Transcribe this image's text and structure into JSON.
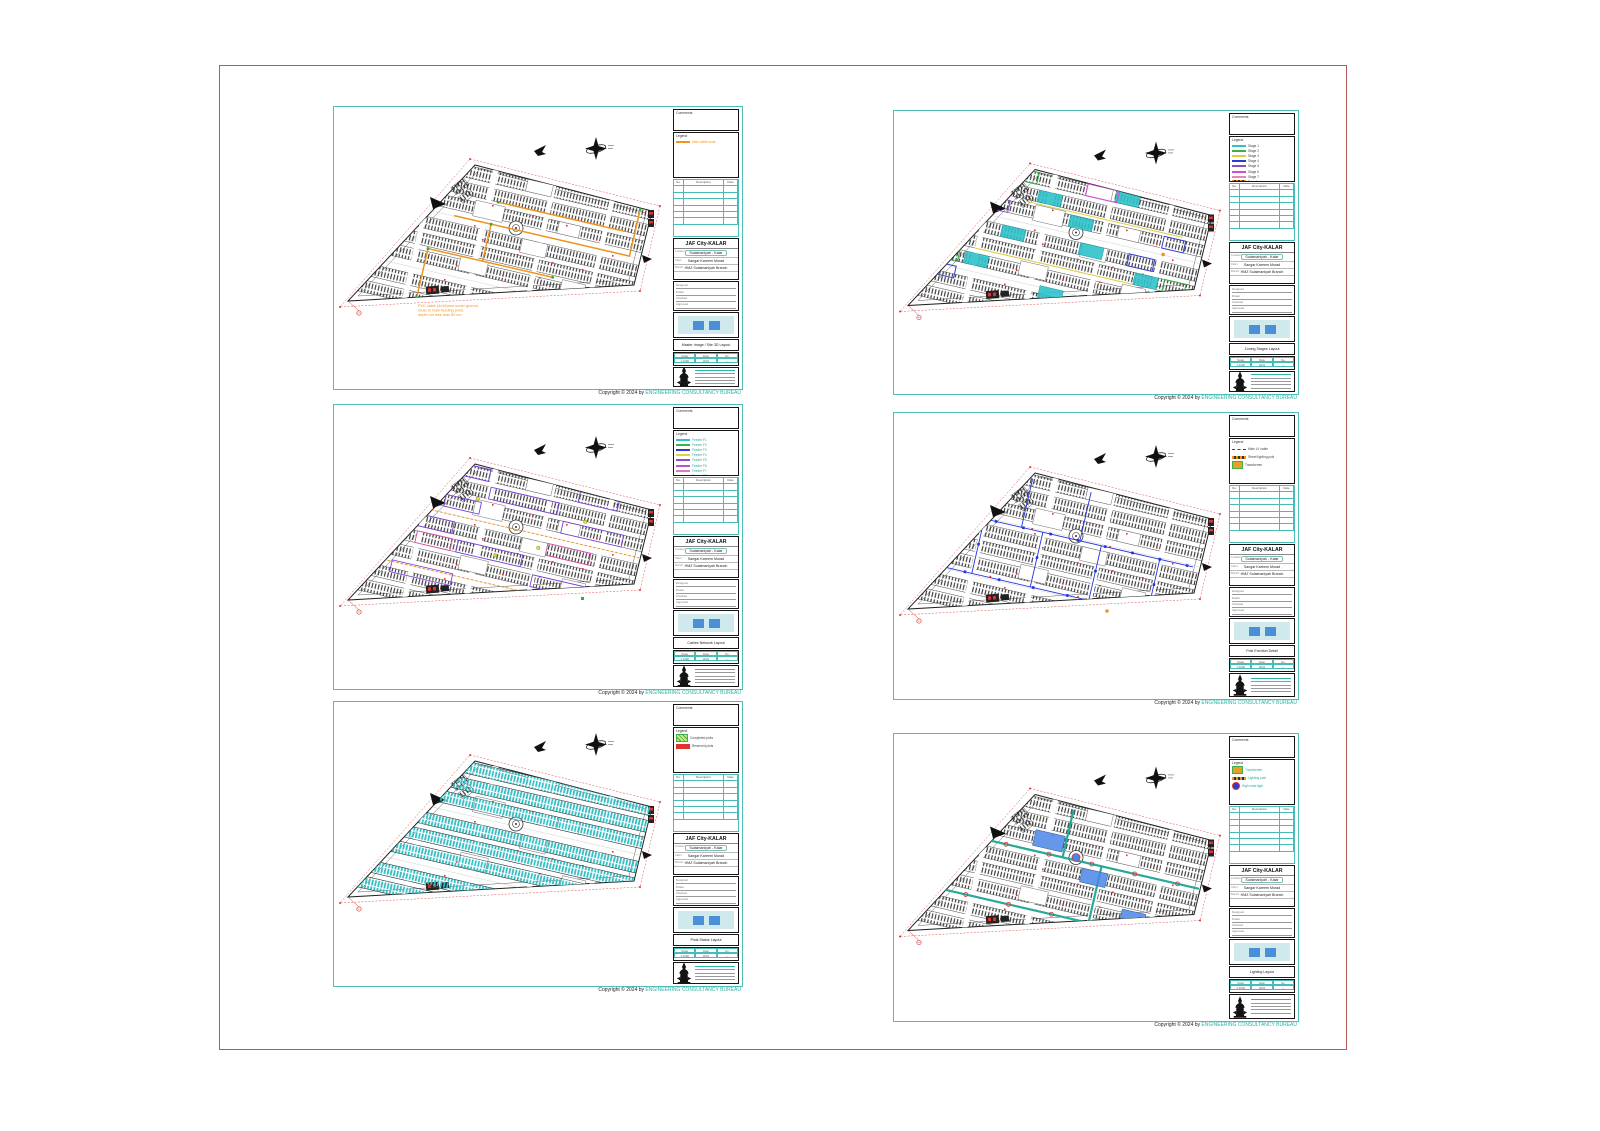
{
  "page": {
    "background": "#ffffff",
    "border_color": "#b25b5b",
    "frame_color": "#4fbdb5"
  },
  "copyright": {
    "prefix": "Copyright ©  2024 by ",
    "company": "ENGINEERING CONSULTANCY BUREAU",
    "company_color": "#2ab3a6"
  },
  "title_block": {
    "comments_label": "Comments",
    "legend_label": "Legend",
    "revision_columns": [
      "No.",
      "Description",
      "Date"
    ],
    "project": {
      "name": "JAF City-KALAR",
      "location": "Sulaimaniyah - Kalar",
      "client": "Sangar Kareem Murad",
      "branch": "HMZ Sulaimaniyah Branch",
      "labels": {
        "location": "Location",
        "client": "Client",
        "branch": "Branch"
      }
    },
    "fields": [
      "Designed",
      "Drawn",
      "Checked",
      "Approved"
    ],
    "mini_table": {
      "headers": [
        "Scale",
        "Date",
        "No."
      ],
      "values": [
        "1:1000",
        "2024",
        "—"
      ]
    }
  },
  "sheets": [
    {
      "name": "sheet-a",
      "title": "Master Image / Site 3D Layout",
      "legend": [
        {
          "label": "Main cable route",
          "color": "#f0941f"
        }
      ],
      "legend_label_color": "#f0941f",
      "annotation": [
        "PVC cable (4x16)mm under ground,",
        "route to main feeding point,",
        "depth not less than 80 cm"
      ],
      "overlay_color": "#f0941f"
    },
    {
      "name": "sheet-b",
      "title": "Zoning Stages Layout",
      "legend": [
        {
          "label": "Stage 1",
          "color": "#2ec2c9"
        },
        {
          "label": "Stage 2",
          "color": "#3fae4c"
        },
        {
          "label": "Stage 3",
          "color": "#ddd040"
        },
        {
          "label": "Stage 4",
          "color": "#2f3bd0"
        },
        {
          "label": "Stage 5",
          "color": "#8a4fc8"
        },
        {
          "label": "Stage 6",
          "color": "#d24fd2"
        },
        {
          "label": "Stage 7",
          "color": "#e08ab4"
        },
        {
          "label": "Transformer",
          "color": "#f0941f"
        }
      ],
      "legend_label_color": "#444444",
      "annotation": [],
      "overlay_color": "multi"
    },
    {
      "name": "sheet-c",
      "title": "Cables Network Layout",
      "legend": [
        {
          "label": "Feeder F1",
          "color": "#2ec2c9"
        },
        {
          "label": "Feeder F2",
          "color": "#3fae4c"
        },
        {
          "label": "Feeder F3",
          "color": "#2f3bd0"
        },
        {
          "label": "Feeder F4",
          "color": "#e0d23c"
        },
        {
          "label": "Feeder F5",
          "color": "#8a4fc8"
        },
        {
          "label": "Feeder F6",
          "color": "#b05ad2"
        },
        {
          "label": "Feeder F7",
          "color": "#e07ab8"
        },
        {
          "label": "Feeder F8",
          "color": "#a05050"
        }
      ],
      "legend_label_color": "#2aa89d",
      "annotation": [],
      "overlay_color": "#7a3fd2"
    },
    {
      "name": "sheet-d",
      "title": "Pole Erection Detail",
      "legend": [
        {
          "label": "Main LV cable",
          "color": "#2233dd"
        },
        {
          "label": "Street lighting pole",
          "color": "#f0941f"
        },
        {
          "label": "Transformer",
          "color": "#3fae4c"
        }
      ],
      "legend_label_color": "#444444",
      "annotation": [],
      "overlay_color": "#2233dd"
    },
    {
      "name": "sheet-e",
      "title": "Plots Status Layout",
      "legend": [
        {
          "label": "Completed plots",
          "color": "#3fae4c"
        },
        {
          "label": "Reserved plots",
          "color": "#e03030"
        }
      ],
      "legend_label_color": "#444444",
      "annotation": [],
      "overlay_color": "#2ec2c9"
    },
    {
      "name": "sheet-f",
      "title": "Lighting Layout",
      "legend": [
        {
          "label": "Transformer",
          "color": "#3fae4c"
        },
        {
          "label": "Lighting pole",
          "color": "#f0941f"
        },
        {
          "label": "High mast light",
          "color": "#2f3bd0"
        }
      ],
      "legend_label_color": "#2aa89d",
      "annotation": [],
      "overlay_color": "#2aa898"
    }
  ],
  "colors": {
    "frame_teal": "#4fbdb5",
    "page_border_red": "#b25b5b",
    "dim_red": "#e05050",
    "marker_red": "#e03535",
    "overlay_orange": "#f0941f",
    "overlay_cyan": "#2ec2c9",
    "overlay_blue": "#2233dd",
    "overlay_purple": "#7a3fd2",
    "overlay_magenta": "#d24fa0",
    "overlay_green": "#2fae3f",
    "overlay_yellow": "#ddd040",
    "overlay_teal_road": "#2aa898",
    "thumbnail_blue": "#4a90d9",
    "copyright_teal": "#2ab3a6"
  }
}
